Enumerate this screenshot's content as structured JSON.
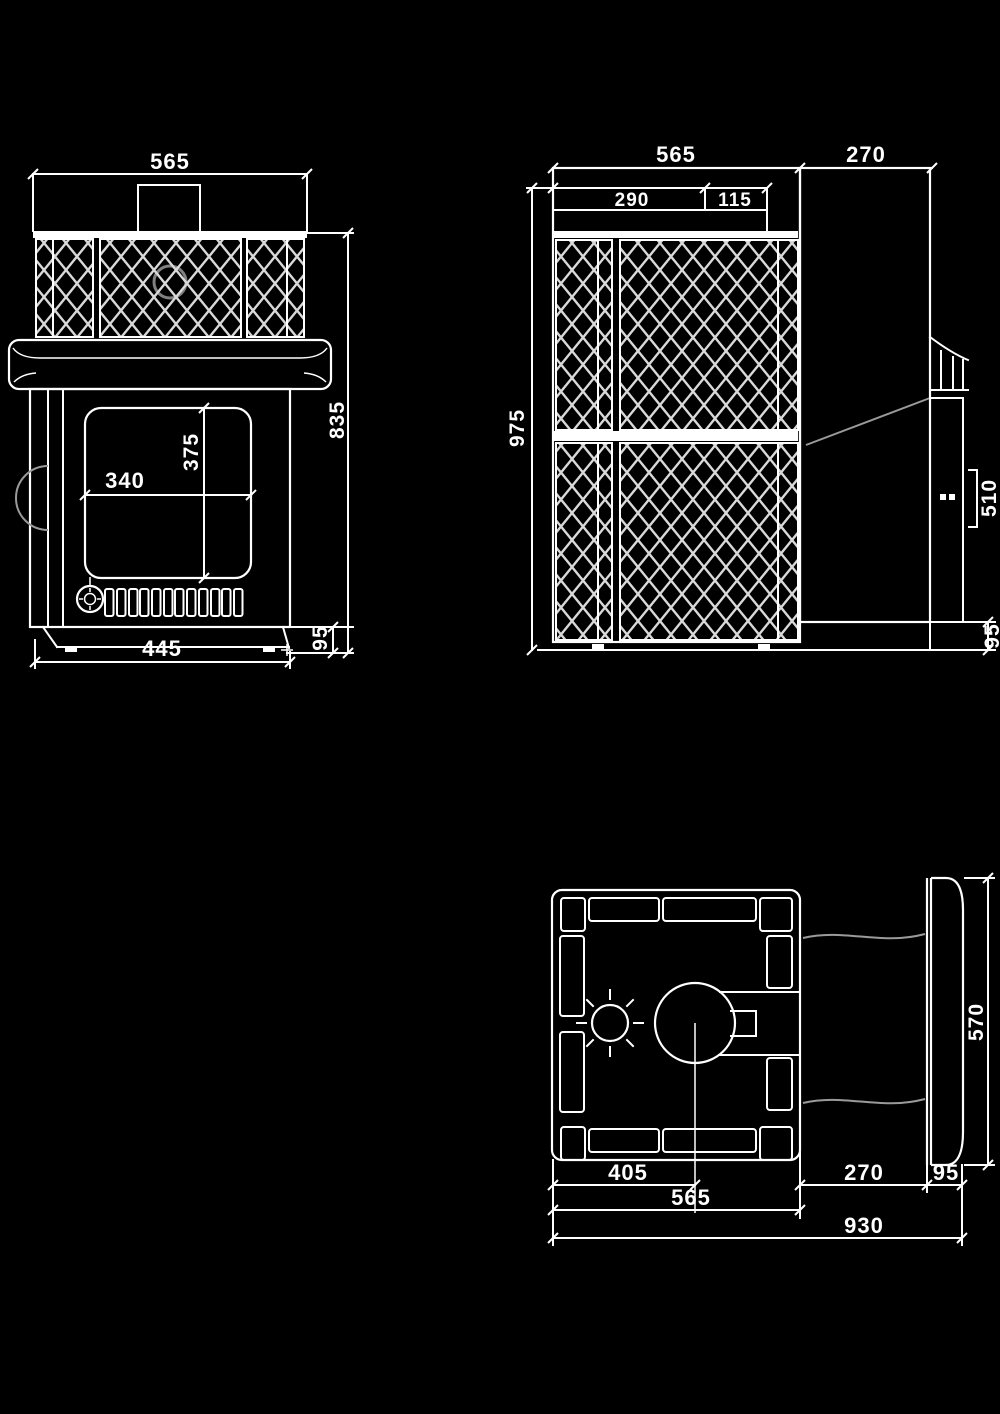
{
  "drawing": {
    "kind": "stove-three-view-technical-drawing",
    "colors": {
      "background": "#000000",
      "line": "#ffffff",
      "mesh": "#d9d9d9",
      "secondary_line": "#9a9a9a"
    },
    "views": {
      "front": {
        "dim_top_width": "565",
        "dim_glass_width": "340",
        "dim_glass_height": "375",
        "dim_body_height": "835",
        "dim_base_height": "95",
        "dim_base_width": "445"
      },
      "side": {
        "dim_depth": "565",
        "dim_tunnel": "270",
        "dim_chimney_offset": "290",
        "dim_chimney_width": "115",
        "dim_total_height": "975",
        "dim_door_frame": "510",
        "dim_base_height": "95"
      },
      "plan": {
        "dim_chimney_center": "405",
        "dim_depth": "565",
        "dim_tunnel": "270",
        "dim_flange": "95",
        "dim_total_depth": "930",
        "dim_flange_height": "570"
      }
    }
  }
}
